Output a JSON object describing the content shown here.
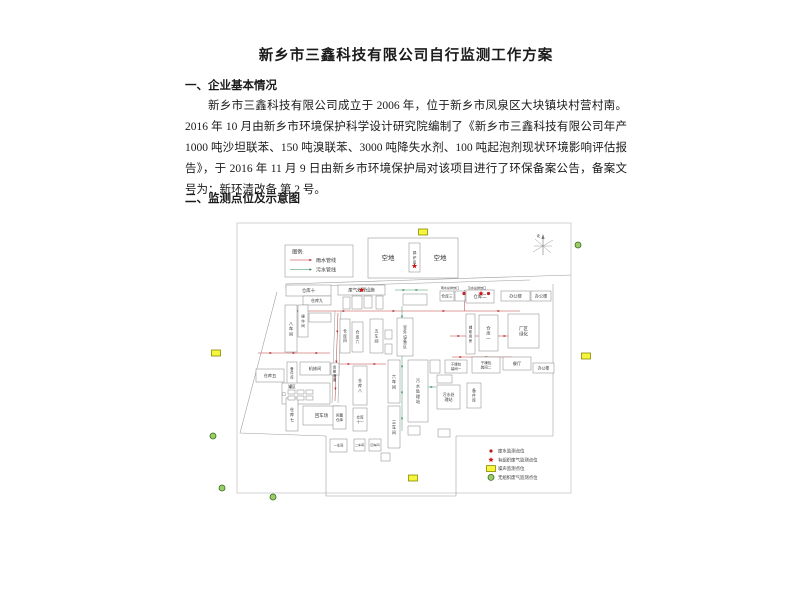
{
  "document": {
    "title": "新乡市三鑫科技有限公司自行监测工作方案",
    "sections": [
      {
        "heading": "一、企业基本情况",
        "paragraph": "新乡市三鑫科技有限公司成立于 2006 年，位于新乡市凤泉区大块镇块村营村南。2016 年 10 月由新乡市环境保护科学设计研究院编制了《新乡市三鑫科技有限公司年产 1000 吨沙坦联苯、150 吨溴联苯、3000 吨降失水剂、100 吨起泡剂现状环境影响评估报告》，于 2016 年 11 月 9 日由新乡市环境保护局对该项目进行了环保备案公告，备案文号为：新环清改备 第 2 号。"
      },
      {
        "heading": "二、监测点位及示意图"
      }
    ]
  },
  "diagram": {
    "compass_label": "北",
    "colors": {
      "rain": "#b22222",
      "sewage": "#2e8b57",
      "noise_fill": "#f5f53c",
      "noise_stroke": "#8a8a00",
      "gas_fill": "#9ccc65",
      "gas_stroke": "#33691e",
      "star": "#cc1111",
      "dot": "#bb2222",
      "outline": "#9a9a9a",
      "building": "#777777",
      "text": "#333333"
    },
    "pipe_legend": {
      "title": "图例:",
      "items": [
        {
          "label": "雨水管线",
          "color_key": "rain"
        },
        {
          "label": "污水管线",
          "color_key": "sewage"
        }
      ],
      "box": {
        "x": 85,
        "y": 27,
        "w": 68,
        "h": 32
      }
    },
    "monitor_legend": {
      "x": 286,
      "y": 233,
      "items": [
        {
          "type": "red-dot",
          "label": "废水监测点位"
        },
        {
          "type": "red-star",
          "label": "有组织废气监测点位"
        },
        {
          "type": "yellow-rect",
          "label": "噪声监测点位"
        },
        {
          "type": "green-circle",
          "label": "无组织废气监测点位"
        }
      ]
    },
    "boundary_lines": [
      {
        "pts": [
          [
            85,
            66
          ],
          [
            371,
            57
          ]
        ]
      },
      {
        "pts": [
          [
            85,
            69
          ],
          [
            330,
            62
          ]
        ]
      },
      {
        "pts": [
          [
            77,
            74
          ],
          [
            40,
            215
          ],
          [
            126,
            218
          ]
        ]
      },
      {
        "pts": [
          [
            126,
            218
          ],
          [
            126,
            278
          ],
          [
            256,
            278
          ],
          [
            256,
            218
          ]
        ]
      },
      {
        "pts": [
          [
            256,
            218
          ],
          [
            353,
            218
          ]
        ]
      },
      {
        "pts": [
          [
            353,
            218
          ],
          [
            353,
            66
          ]
        ]
      },
      {
        "pts": [
          [
            135,
            93
          ],
          [
            132,
            185
          ]
        ]
      },
      {
        "pts": [
          [
            141,
            93
          ],
          [
            138,
            185
          ]
        ]
      }
    ],
    "border_rect": {
      "x": 37,
      "y": 5,
      "w": 334,
      "h": 270
    },
    "buildings": [
      {
        "label": "",
        "x": 168,
        "y": 20,
        "w": 90,
        "h": 40
      },
      {
        "label": "锅炉房",
        "x": 209,
        "y": 25,
        "w": 11,
        "h": 29,
        "v": true,
        "fs": 3.6
      },
      {
        "label": "仓库十",
        "x": 86,
        "y": 67,
        "w": 45,
        "h": 11,
        "fs": 4.4
      },
      {
        "label": "仓库九",
        "x": 103,
        "y": 78,
        "w": 28,
        "h": 9,
        "fs": 4.1
      },
      {
        "label": "八车间",
        "x": 85,
        "y": 87,
        "w": 12,
        "h": 47,
        "v": true,
        "fs": 4.2
      },
      {
        "label": "操作间",
        "x": 98,
        "y": 87,
        "w": 10,
        "h": 32,
        "v": true,
        "fs": 3.6
      },
      {
        "label": "",
        "x": 109,
        "y": 95,
        "w": 22,
        "h": 9
      },
      {
        "label": "废气处理设施",
        "x": 138,
        "y": 67,
        "w": 47,
        "h": 10,
        "fs": 4.4
      },
      {
        "label": "",
        "x": 143,
        "y": 79,
        "w": 7,
        "h": 12
      },
      {
        "label": "",
        "x": 152,
        "y": 78,
        "w": 10,
        "h": 13
      },
      {
        "label": "",
        "x": 164,
        "y": 78,
        "w": 8,
        "h": 12
      },
      {
        "label": "",
        "x": 176,
        "y": 78,
        "w": 7,
        "h": 13
      },
      {
        "label": "",
        "x": 203,
        "y": 76,
        "w": 24,
        "h": 11
      },
      {
        "label": "仓库三",
        "x": 240,
        "y": 73,
        "w": 14,
        "h": 10,
        "fs": 3.8
      },
      {
        "label": "",
        "x": 255,
        "y": 73,
        "w": 10,
        "h": 10
      },
      {
        "label": "仓库二",
        "x": 266,
        "y": 72,
        "w": 28,
        "h": 13,
        "fs": 4.4
      },
      {
        "label": "办公楼",
        "x": 301,
        "y": 73,
        "w": 29,
        "h": 10,
        "fs": 4.2
      },
      {
        "label": "办公楼",
        "x": 331,
        "y": 73,
        "w": 20,
        "h": 10,
        "fs": 4.2
      },
      {
        "label": "仓库四",
        "x": 140,
        "y": 101,
        "w": 10,
        "h": 34,
        "v": true,
        "fs": 3.8
      },
      {
        "label": "仓库六",
        "x": 152,
        "y": 104,
        "w": 11,
        "h": 30,
        "v": true,
        "fs": 3.8
      },
      {
        "label": "五车间",
        "x": 170,
        "y": 101,
        "w": 13,
        "h": 34,
        "v": true,
        "fs": 4.0
      },
      {
        "label": "",
        "x": 185,
        "y": 112,
        "w": 7,
        "h": 9
      },
      {
        "label": "",
        "x": 185,
        "y": 126,
        "w": 7,
        "h": 10
      },
      {
        "label": "室外设备区",
        "x": 197,
        "y": 100,
        "w": 16,
        "h": 38,
        "v": true,
        "fs": 3.8
      },
      {
        "label": "辅助用房",
        "x": 266,
        "y": 96,
        "w": 9,
        "h": 40,
        "v": true,
        "fs": 3.4
      },
      {
        "label": "仓库一",
        "x": 279,
        "y": 97,
        "w": 19,
        "h": 36,
        "v": true,
        "fs": 4.2
      },
      {
        "label": "厂区\n绿化",
        "x": 308,
        "y": 96,
        "w": 31,
        "h": 34,
        "fs": 4.4
      },
      {
        "label": "仓库五",
        "x": 56,
        "y": 151,
        "w": 28,
        "h": 13,
        "fs": 4.2
      },
      {
        "label": "备件库",
        "x": 87,
        "y": 144,
        "w": 10,
        "h": 22,
        "v": true,
        "fs": 3.4
      },
      {
        "label": "机修间",
        "x": 100,
        "y": 144,
        "w": 30,
        "h": 13,
        "fs": 4.2
      },
      {
        "label": "",
        "x": 131,
        "y": 145,
        "w": 8,
        "h": 12
      },
      {
        "label": "",
        "x": 82,
        "y": 165,
        "w": 48,
        "h": 21
      },
      {
        "label": "仓库八",
        "x": 153,
        "y": 148,
        "w": 14,
        "h": 39,
        "v": true,
        "fs": 4.0
      },
      {
        "label": "六车间",
        "x": 188,
        "y": 142,
        "w": 12,
        "h": 43,
        "v": true,
        "fs": 4.2
      },
      {
        "label": "三车间",
        "x": 188,
        "y": 188,
        "w": 12,
        "h": 42,
        "v": true,
        "fs": 4.2
      },
      {
        "label": "污水处理站",
        "x": 208,
        "y": 142,
        "w": 20,
        "h": 62,
        "v": true,
        "fs": 4.2
      },
      {
        "label": "污水处\n理站",
        "x": 237,
        "y": 167,
        "w": 23,
        "h": 24,
        "fs": 4.0
      },
      {
        "label": "备件库",
        "x": 267,
        "y": 165,
        "w": 14,
        "h": 25,
        "v": true,
        "fs": 3.8
      },
      {
        "label": "",
        "x": 237,
        "y": 157,
        "w": 15,
        "h": 8
      },
      {
        "label": "",
        "x": 230,
        "y": 142,
        "w": 10,
        "h": 13
      },
      {
        "label": "",
        "x": 208,
        "y": 208,
        "w": 12,
        "h": 9
      },
      {
        "label": "",
        "x": 238,
        "y": 211,
        "w": 12,
        "h": 8
      },
      {
        "label": "干燥包\n装间一",
        "x": 245,
        "y": 142,
        "w": 22,
        "h": 13,
        "fs": 3.4
      },
      {
        "label": "干燥包\n装间二",
        "x": 272,
        "y": 139,
        "w": 28,
        "h": 16,
        "fs": 3.6
      },
      {
        "label": "餐厅",
        "x": 303,
        "y": 139,
        "w": 28,
        "h": 13,
        "fs": 4.2
      },
      {
        "label": "办公楼",
        "x": 333,
        "y": 145,
        "w": 21,
        "h": 10,
        "fs": 3.8
      },
      {
        "label": "仓库七",
        "x": 86,
        "y": 180,
        "w": 12,
        "h": 33,
        "v": true,
        "fs": 4.2
      },
      {
        "label": "回车场",
        "x": 103,
        "y": 188,
        "w": 37,
        "h": 19,
        "fs": 4.4
      },
      {
        "label": "闲置\n仓库",
        "x": 133,
        "y": 188,
        "w": 13,
        "h": 23,
        "fs": 3.6
      },
      {
        "label": "仓库\n十一",
        "x": 153,
        "y": 190,
        "w": 14,
        "h": 23,
        "fs": 3.6
      },
      {
        "label": "一车间",
        "x": 130,
        "y": 221,
        "w": 17,
        "h": 13,
        "fs": 3.2
      },
      {
        "label": "二车间",
        "x": 154,
        "y": 221,
        "w": 11,
        "h": 12,
        "fs": 3.0
      },
      {
        "label": "四车间",
        "x": 169,
        "y": 221,
        "w": 12,
        "h": 12,
        "fs": 3.0
      },
      {
        "label": "",
        "x": 181,
        "y": 235,
        "w": 9,
        "h": 8
      },
      {
        "label": "",
        "x": 88,
        "y": 172,
        "w": 7,
        "h": 4
      },
      {
        "label": "",
        "x": 97,
        "y": 172,
        "w": 7,
        "h": 4
      },
      {
        "label": "",
        "x": 106,
        "y": 172,
        "w": 7,
        "h": 4
      },
      {
        "label": "",
        "x": 88,
        "y": 178,
        "w": 7,
        "h": 4
      },
      {
        "label": "",
        "x": 97,
        "y": 178,
        "w": 7,
        "h": 4
      },
      {
        "label": "",
        "x": 106,
        "y": 178,
        "w": 7,
        "h": 4
      }
    ],
    "floating_labels": [
      {
        "text": "空地",
        "x": 188,
        "y": 42,
        "fs": 6.5
      },
      {
        "text": "空地",
        "x": 240,
        "y": 42,
        "fs": 6.5
      },
      {
        "text": "雨水总排放口",
        "x": 250,
        "y": 70.8,
        "fs": 3.1
      },
      {
        "text": "污水总排放口",
        "x": 277,
        "y": 70.8,
        "fs": 3.1
      },
      {
        "text": "罐区",
        "x": 92,
        "y": 170,
        "fs": 3.8
      },
      {
        "text": "运输通道",
        "x": 134.5,
        "y": 150,
        "fs": 3.4,
        "v": true
      }
    ],
    "pipes": [
      {
        "color_key": "rain",
        "pts": [
          [
            88,
            93
          ],
          [
            320,
            93
          ]
        ],
        "arrows": [
          {
            "x": 100,
            "y": 93,
            "a": 0
          },
          {
            "x": 145,
            "y": 93,
            "a": 0
          },
          {
            "x": 195,
            "y": 93,
            "a": 0
          },
          {
            "x": 245,
            "y": 93,
            "a": 0
          },
          {
            "x": 300,
            "y": 93,
            "a": 0
          }
        ]
      },
      {
        "color_key": "rain",
        "pts": [
          [
            138,
            95
          ],
          [
            135,
            183
          ]
        ],
        "arrows": [
          {
            "x": 137.3,
            "y": 115,
            "a": 90
          },
          {
            "x": 136.3,
            "y": 145,
            "a": 90
          },
          {
            "x": 135.4,
            "y": 172,
            "a": 90
          }
        ]
      },
      {
        "color_key": "rain",
        "pts": [
          [
            58,
            135
          ],
          [
            130,
            135
          ]
        ],
        "arrows": [
          {
            "x": 72,
            "y": 135,
            "a": 0
          },
          {
            "x": 95,
            "y": 135,
            "a": 0
          },
          {
            "x": 118,
            "y": 135,
            "a": 0
          }
        ]
      },
      {
        "color_key": "rain",
        "pts": [
          [
            140,
            146
          ],
          [
            186,
            146
          ]
        ],
        "arrows": [
          {
            "x": 150,
            "y": 146,
            "a": 0
          },
          {
            "x": 176,
            "y": 146,
            "a": 0
          }
        ]
      },
      {
        "color_key": "rain",
        "pts": [
          [
            250,
            118
          ],
          [
            312,
            118
          ]
        ],
        "arrows": [
          {
            "x": 260,
            "y": 118,
            "a": 0
          },
          {
            "x": 285,
            "y": 118,
            "a": 0
          },
          {
            "x": 306,
            "y": 118,
            "a": 0
          }
        ]
      },
      {
        "color_key": "rain",
        "pts": [
          [
            252,
            139
          ],
          [
            312,
            139
          ]
        ],
        "arrows": [
          {
            "x": 262,
            "y": 139,
            "a": 0
          },
          {
            "x": 288,
            "y": 139,
            "a": 0
          }
        ]
      },
      {
        "color_key": "rain",
        "pts": [
          [
            264.5,
            93
          ],
          [
            264.5,
            72
          ]
        ],
        "arrows": [
          {
            "x": 264.5,
            "y": 80,
            "a": 270
          }
        ]
      },
      {
        "color_key": "sewage",
        "pts": [
          [
            202,
            88
          ],
          [
            202,
            213
          ]
        ],
        "arrows": [
          {
            "x": 202,
            "y": 100,
            "a": 90
          },
          {
            "x": 202,
            "y": 122,
            "a": 90
          },
          {
            "x": 202,
            "y": 150,
            "a": 90
          },
          {
            "x": 202,
            "y": 176,
            "a": 90
          },
          {
            "x": 202,
            "y": 202,
            "a": 90
          }
        ]
      },
      {
        "color_key": "sewage",
        "pts": [
          [
            228,
            169
          ],
          [
            236,
            169
          ]
        ],
        "arrows": [
          {
            "x": 233,
            "y": 169,
            "a": 0
          }
        ]
      },
      {
        "color_key": "sewage",
        "pts": [
          [
            195,
            72
          ],
          [
            228,
            72
          ]
        ],
        "arrows": [
          {
            "x": 205,
            "y": 72,
            "a": 0
          },
          {
            "x": 218,
            "y": 72,
            "a": 0
          }
        ]
      }
    ],
    "markers": [
      {
        "type": "red-star",
        "x": 214.5,
        "y": 48
      },
      {
        "type": "red-star",
        "x": 161.5,
        "y": 72
      },
      {
        "type": "red-star",
        "x": 281,
        "y": 75.5
      },
      {
        "type": "red-dot",
        "x": 264,
        "y": 75.5
      },
      {
        "type": "red-dot",
        "x": 288.5,
        "y": 75.5
      },
      {
        "type": "tank-circle",
        "x": 84,
        "y": 176
      },
      {
        "type": "yellow-rect",
        "x": 223,
        "y": 14
      },
      {
        "type": "yellow-rect",
        "x": 16,
        "y": 135
      },
      {
        "type": "yellow-rect",
        "x": 386,
        "y": 138
      },
      {
        "type": "yellow-rect",
        "x": 213,
        "y": 260
      },
      {
        "type": "green-circle",
        "x": 378,
        "y": 27
      },
      {
        "type": "green-circle",
        "x": 13,
        "y": 218
      },
      {
        "type": "green-circle",
        "x": 22,
        "y": 270
      },
      {
        "type": "green-circle",
        "x": 73,
        "y": 279
      }
    ],
    "compass": {
      "cx": 343,
      "cy": 28
    }
  }
}
